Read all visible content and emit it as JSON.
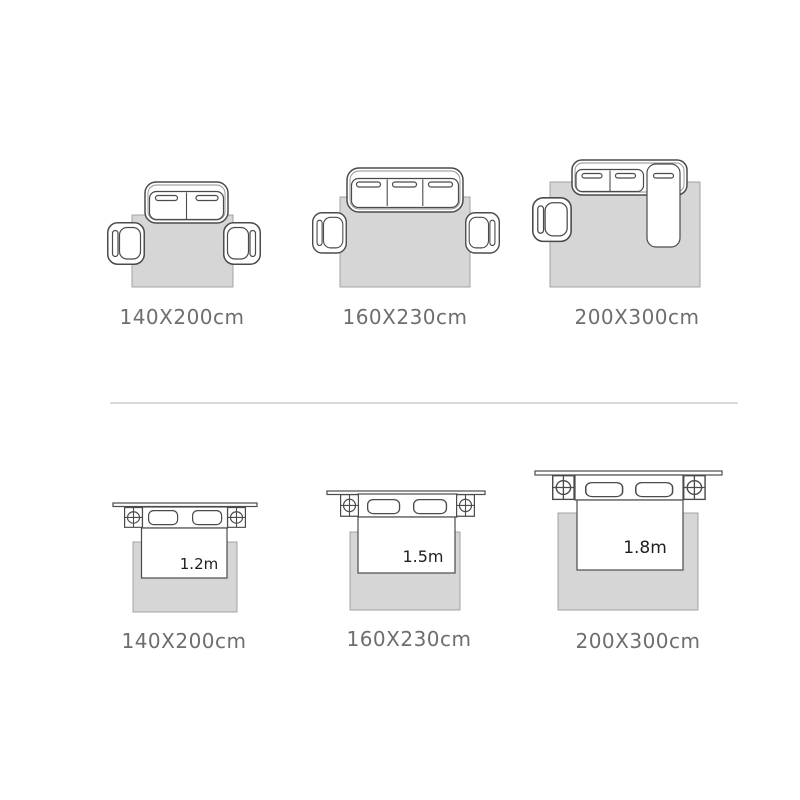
{
  "colors": {
    "background": "#ffffff",
    "rug_fill": "#d6d6d6",
    "rug_border": "#a3a3a3",
    "outline": "#4b4b4b",
    "outline_light": "#8f8f8f",
    "label_text": "#6e6e6e",
    "bed_size_text": "#1e1e1e",
    "divider": "#d9d9d9"
  },
  "sections": {
    "sofa_row": {
      "items": [
        {
          "size_label": "140X200cm",
          "icon": "two-seat-sofa-with-armchairs-rug"
        },
        {
          "size_label": "160X230cm",
          "icon": "three-seat-sofa-with-armchairs-rug"
        },
        {
          "size_label": "200X300cm",
          "icon": "sectional-sofa-with-armchair-rug"
        }
      ]
    },
    "bed_row": {
      "items": [
        {
          "size_label": "140X200cm",
          "bed_width": "1.2m",
          "icon": "bed-with-nightstands-rug"
        },
        {
          "size_label": "160X230cm",
          "bed_width": "1.5m",
          "icon": "bed-with-nightstands-rug"
        },
        {
          "size_label": "200X300cm",
          "bed_width": "1.8m",
          "icon": "bed-with-nightstands-rug"
        }
      ]
    }
  }
}
